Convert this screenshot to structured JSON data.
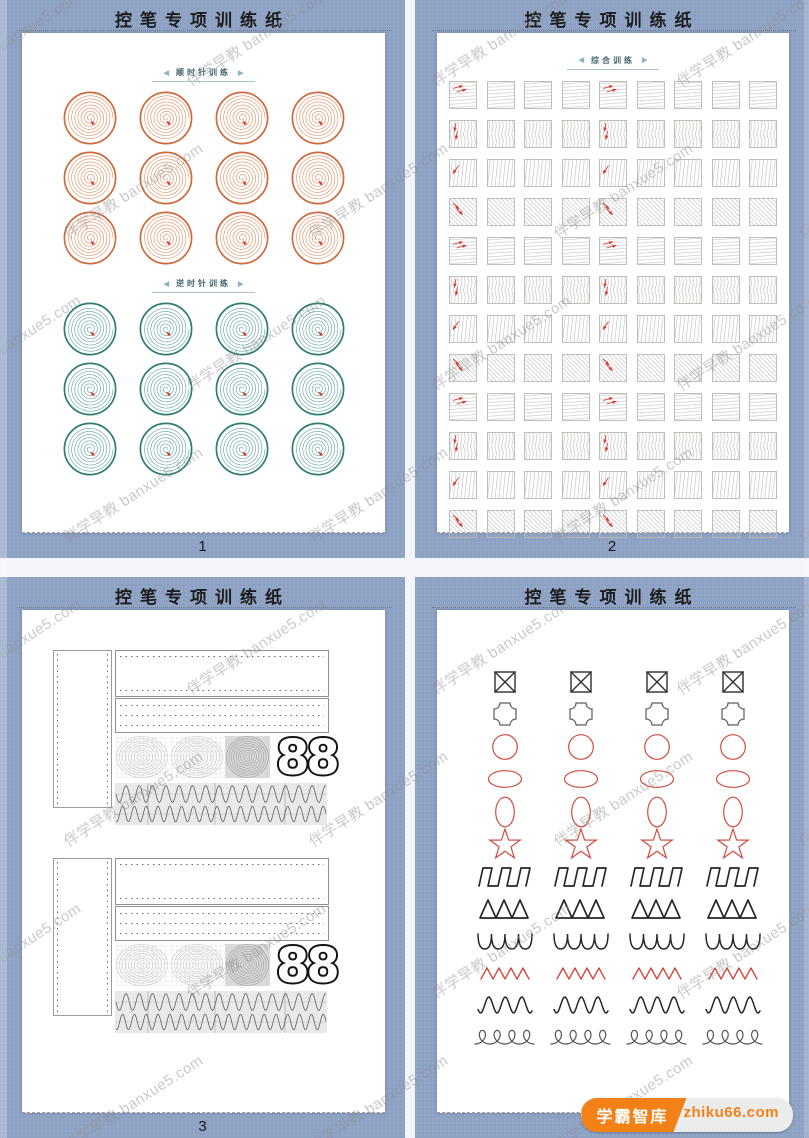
{
  "watermark": {
    "text": "伴学早教 banxue5.com"
  },
  "badge": {
    "brand": "学霸智库",
    "site": "zhiku66.com",
    "brand_bg": "#f28118",
    "site_bg": "#ececec"
  },
  "labels": {
    "arrow_left": "◀",
    "arrow_right": "▶"
  },
  "colors": {
    "viewer_background": "#8da1c4",
    "paper": "#ffffff",
    "accent_red": "#d63b30",
    "clockwise_ring": "#cd6a3c",
    "clockwise_spiral": "#df8c5e",
    "counterclockwise_ring": "#2e7d72",
    "counterclockwise_spiral": "#5ba294"
  },
  "pages": [
    {
      "number": "1",
      "title": "控笔专项训练纸",
      "sections": [
        {
          "label": "顺时针训练",
          "ring_color": "#cd6a3c",
          "spiral_color": "#df8c5e",
          "rows": 3,
          "cols": 4,
          "direction": 1
        },
        {
          "label": "逆时针训练",
          "ring_color": "#2e7d72",
          "spiral_color": "#5ba294",
          "rows": 3,
          "cols": 4,
          "direction": -1
        }
      ]
    },
    {
      "number": "2",
      "title": "控笔专项训练纸",
      "label": "综合训练",
      "grid": {
        "rows": 12,
        "cols": 9,
        "row_patterns": [
          "hatch",
          "vzigzag",
          "fdiag",
          "bdiag",
          "hatch",
          "vzigzag",
          "fdiag",
          "bdiag",
          "hatch",
          "vzigzag",
          "fdiag",
          "bdiag"
        ],
        "arrow_columns": [
          0,
          4
        ]
      }
    },
    {
      "number": "3",
      "title": "控笔专项训练纸",
      "blocks": 2,
      "big_text": "88"
    },
    {
      "number": "4",
      "title": "控笔专项训练纸",
      "columns": 4,
      "shape_rows": [
        {
          "shape": "boxed-x",
          "color": "#2f2f2f"
        },
        {
          "shape": "notched-square",
          "color": "#5a5a5a"
        },
        {
          "shape": "circle",
          "color": "#cf4b40"
        },
        {
          "shape": "ellipse-horizontal",
          "color": "#cf4b40"
        },
        {
          "shape": "ellipse-vertical",
          "color": "#cf4b40"
        },
        {
          "shape": "star",
          "color": "#cf4b40"
        },
        {
          "shape": "square-wave",
          "color": "#262626"
        },
        {
          "shape": "triangle-wave",
          "color": "#262626"
        },
        {
          "shape": "scallop-wave",
          "color": "#262626"
        },
        {
          "shape": "zigzag-wave",
          "color": "#cf4b40"
        },
        {
          "shape": "sine-wave",
          "color": "#262626"
        },
        {
          "shape": "loop-wave",
          "color": "#555555"
        }
      ]
    }
  ]
}
